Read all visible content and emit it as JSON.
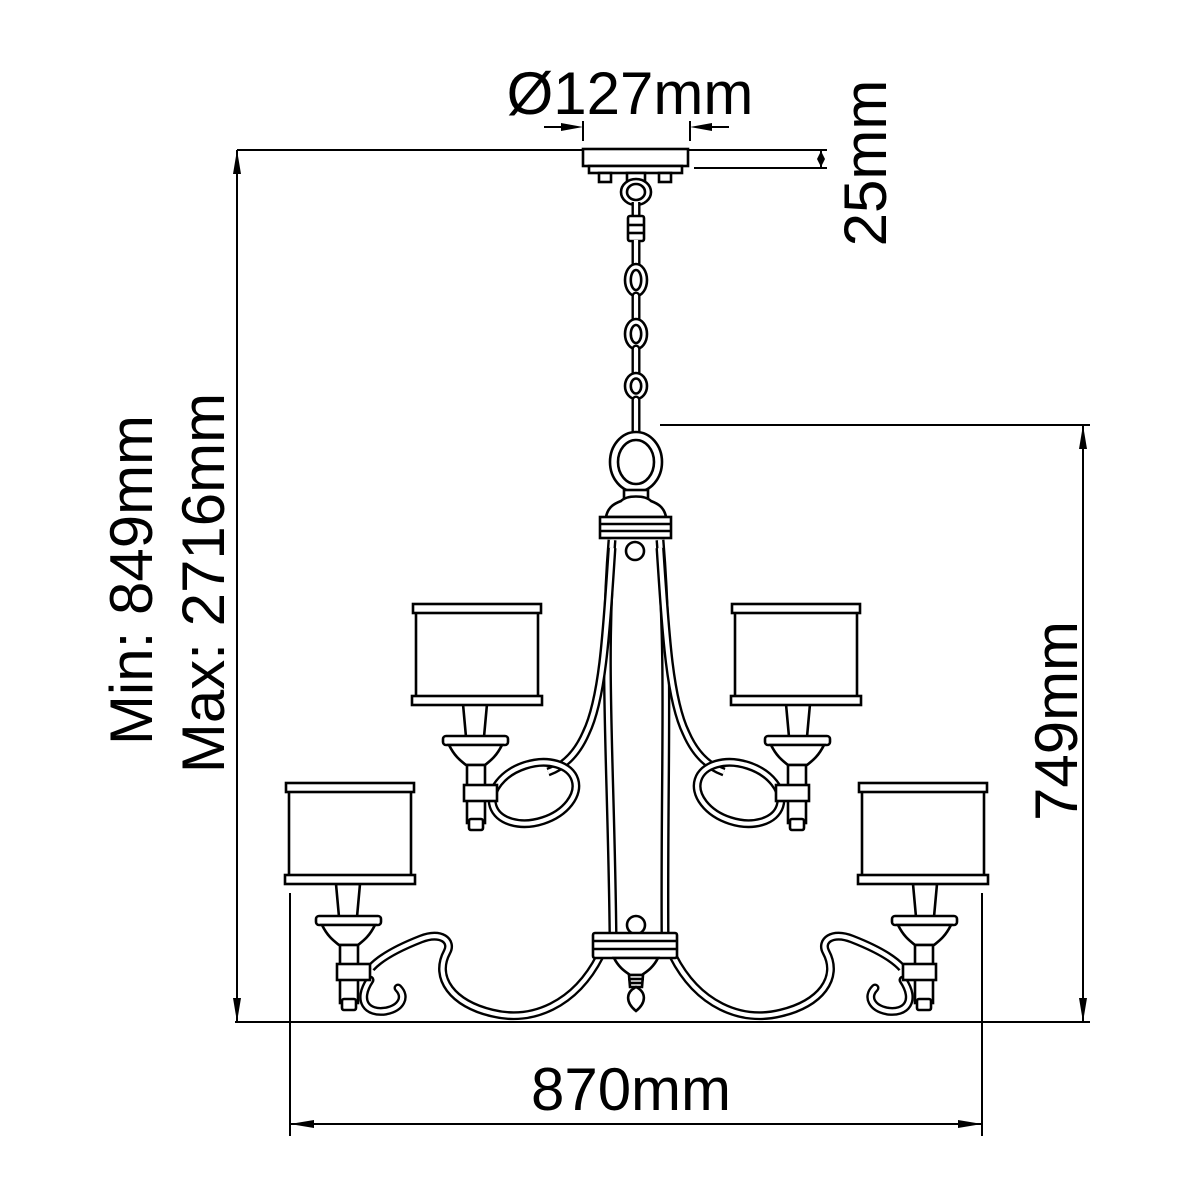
{
  "diagram": {
    "title": "chandelier-dimension-drawing",
    "background_color": "#ffffff",
    "line_color": "#000000",
    "dimensions": {
      "canopy_diameter": "Ø127mm",
      "canopy_height": "25mm",
      "min_height": "Min: 849mm",
      "max_height": "Max: 2716mm",
      "fixture_height": "749mm",
      "fixture_width": "870mm"
    }
  }
}
